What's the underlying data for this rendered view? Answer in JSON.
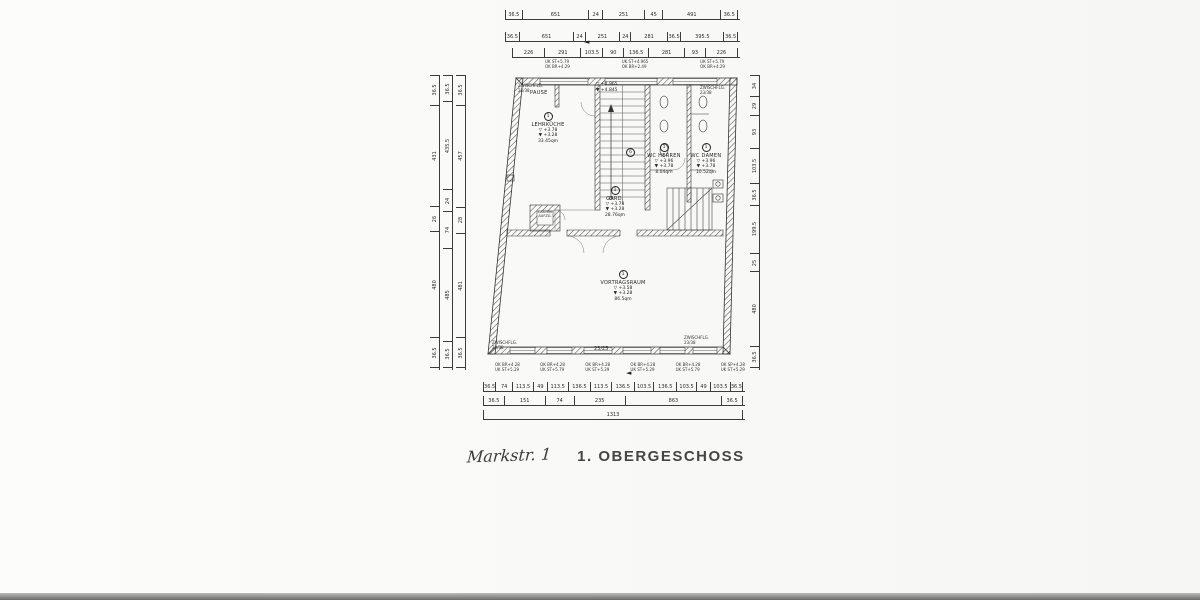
{
  "title": {
    "hand": "Markstr. 1",
    "stamp": "1. OBERGESCHOSS"
  },
  "rooms": {
    "pause": {
      "name": "PAUSE"
    },
    "lehrkueche": {
      "num": "1",
      "name": "LEHRKÜCHE",
      "l1": "▽ +3.78",
      "l2": "▼ +3.28",
      "area": "33.45qm"
    },
    "stairwell": {
      "num": "6",
      "l1": "▽ +4.965",
      "l2": "▼ +4.845"
    },
    "wc_herren": {
      "num": "1",
      "name": "WC HERREN",
      "l1": "▽ +3.96",
      "l2": "▼ +3.78",
      "area": "8.04qm"
    },
    "wc_damen": {
      "num": "1",
      "name": "WC DAMEN",
      "l1": "▽ +3.96",
      "l2": "▼ +3.78",
      "area": "10.52qm"
    },
    "gard": {
      "num": "1",
      "name": "GARD.",
      "l1": "▽ +3.78",
      "l2": "▼ +3.28",
      "area": "28.76qm"
    },
    "vortragsraum": {
      "num": "1",
      "name": "VORTRAGSRAUM",
      "l1": "▽ +3.58",
      "l2": "▼ +3.28",
      "area": "86.5qm"
    },
    "lastenaufzug": {
      "line1": "LASTEN",
      "line2": "AUFZG."
    }
  },
  "corner_labels": {
    "tl": {
      "l1": "ZWISCHFLG.",
      "l2": "23/38"
    },
    "tr": {
      "l1": "ZWISCHFLG.",
      "l2": "23/38"
    },
    "bl": {
      "l1": "ZWISCHFLG.",
      "l2": "23/38"
    },
    "br": {
      "l1": "ZWISCHFLG.",
      "l2": "23/38"
    }
  },
  "wall_notes_top": [
    {
      "l1": "UK ST+5.79",
      "l2": "OK BR+4.29"
    },
    {
      "l1": "UK ST+4.965",
      "l2": "OK BR+2.49"
    },
    {
      "l1": "UK ST+5.79",
      "l2": "OK BR+4.29"
    }
  ],
  "wall_notes_bottom": [
    {
      "l1": "OK BR+4.28",
      "l2": "UK ST+5.29"
    },
    {
      "l1": "OK BR+4.28",
      "l2": "UK ST+5.79"
    },
    {
      "l1": "OK BR+4.28",
      "l2": "UK ST+5.29"
    },
    {
      "l1": "OK BR+4.28",
      "l2": "UK ST+5.29"
    },
    {
      "l1": "OK BR+4.28",
      "l2": "UK ST+5.79"
    },
    {
      "l1": "OK SP+4.28",
      "l2": "UK ST+5.29"
    }
  ],
  "dims": {
    "top1": [
      "36.5",
      "651",
      "24",
      "251",
      "45",
      "491",
      "36.5"
    ],
    "top2": [
      "36.5",
      "651",
      "24",
      "251",
      "24",
      "281",
      "36.5",
      "395.5",
      "36.5"
    ],
    "top3": [
      "226",
      "291",
      "103.5",
      "90",
      "136.5",
      "281",
      "93",
      "226"
    ],
    "left1": [
      "36.5",
      "431",
      "26",
      "480",
      "36.5"
    ],
    "left2": [
      "36.5",
      "435.5",
      "24",
      "74",
      "485",
      "36.5"
    ],
    "left3": [
      "36.5",
      "457",
      "28",
      "481",
      "36.5"
    ],
    "right1": [
      "34",
      "29",
      "93",
      "103.5",
      "36.5",
      "199.5",
      "25",
      "480",
      "36.5"
    ],
    "bottom1": [
      "36.5",
      "74",
      "113.5",
      "49",
      "113.5",
      "136.5",
      "113.5",
      "136.5",
      "103.5",
      "136.5",
      "103.5",
      "49",
      "103.5",
      "36.5"
    ],
    "bottom2": [
      "36.5",
      "151",
      "74",
      "235",
      "863",
      "36.5"
    ],
    "bottom3": [
      "1313"
    ],
    "mid_wall": "23/25"
  },
  "icons": {
    "marker_arrow": "◄"
  }
}
